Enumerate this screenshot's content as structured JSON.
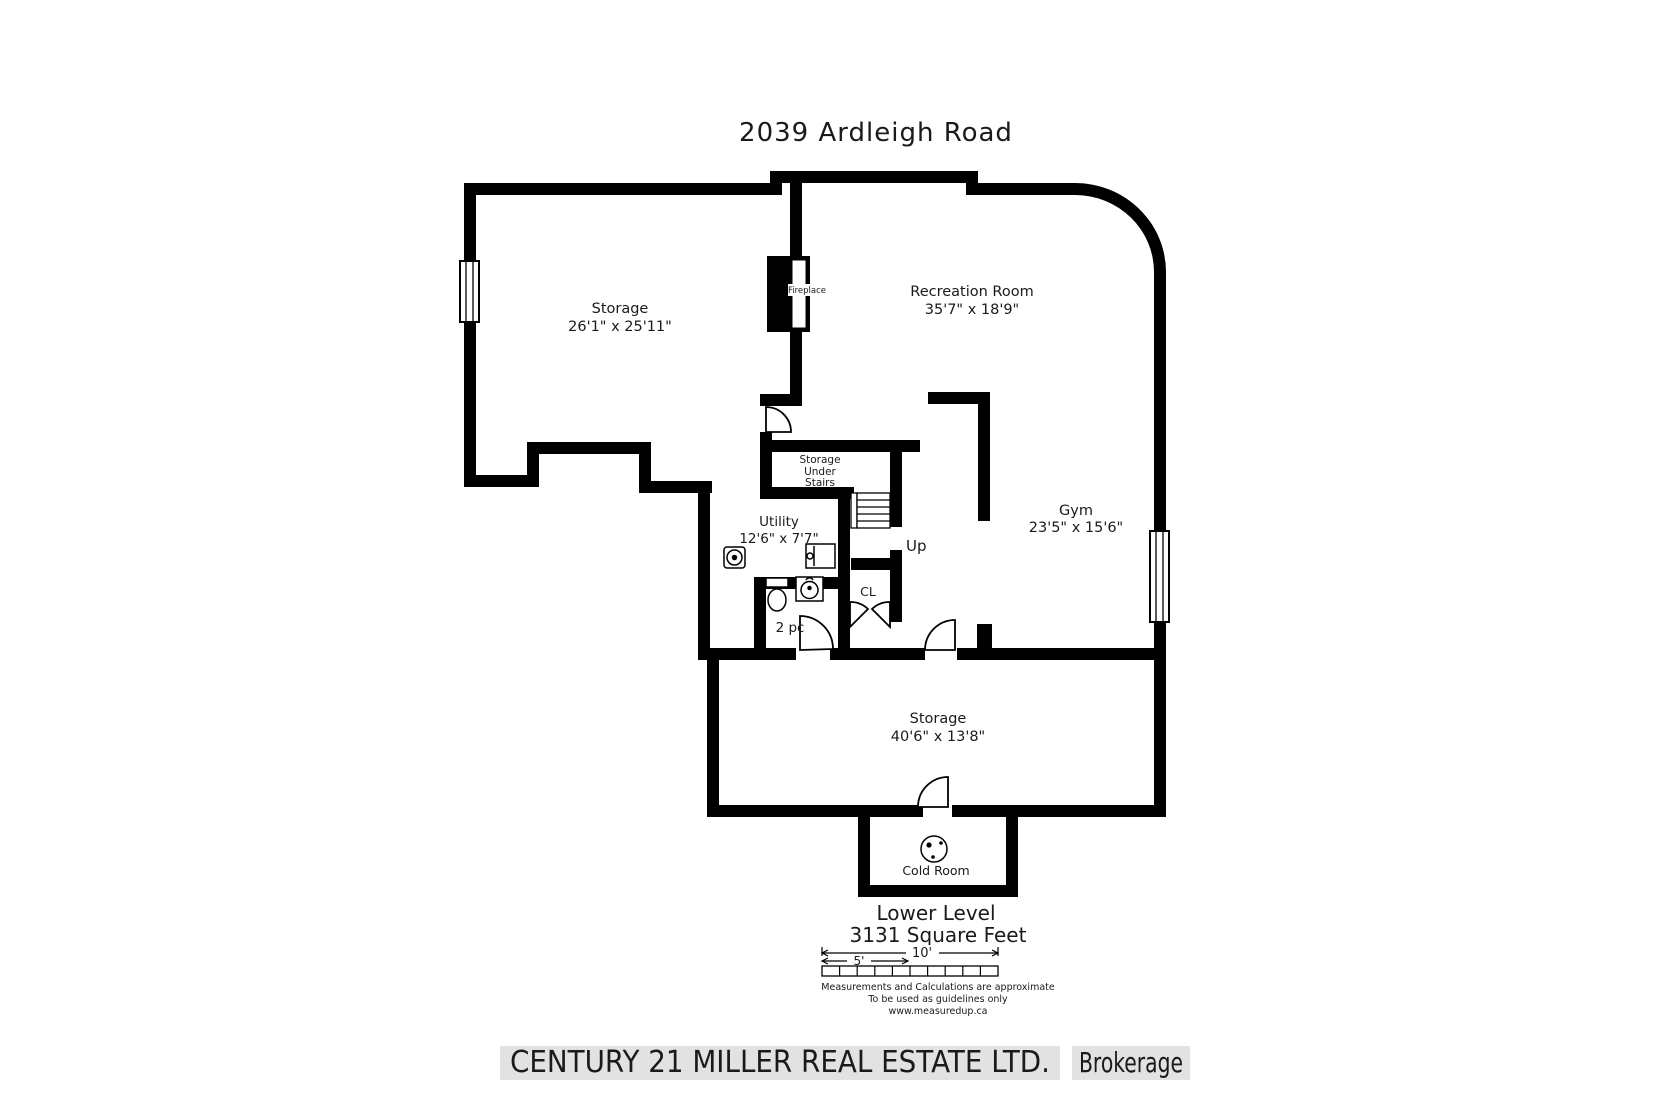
{
  "title": "2039 Ardleigh Road",
  "rooms": {
    "storage_upper": {
      "name": "Storage",
      "dims": "26'1\" x 25'11\""
    },
    "recreation": {
      "name": "Recreation Room",
      "dims": "35'7\" x 18'9\""
    },
    "gym": {
      "name": "Gym",
      "dims": "23'5\" x 15'6\""
    },
    "utility": {
      "name": "Utility",
      "dims": "12'6\" x 7'7\""
    },
    "storage_under_stairs": {
      "line1": "Storage",
      "line2": "Under",
      "line3": "Stairs"
    },
    "bathroom": {
      "name": "2 pc"
    },
    "closet": {
      "name": "CL"
    },
    "storage_lower": {
      "name": "Storage",
      "dims": "40'6\" x 13'8\""
    },
    "cold_room": {
      "name": "Cold Room"
    },
    "fireplace": {
      "name": "Fireplace"
    },
    "stairs": {
      "up_label": "Up"
    }
  },
  "footer": {
    "level": "Lower Level",
    "area": "3131 Square Feet",
    "scale_10": "10'",
    "scale_5": "5'",
    "note1": "Measurements and Calculations are approximate",
    "note2": "To be used as guidelines only",
    "note3": "www.measuredup.ca"
  },
  "watermark": {
    "company": "CENTURY 21 MILLER REAL ESTATE LTD.",
    "suffix": "Brokerage"
  },
  "colors": {
    "wall": "#000000",
    "text": "#1a1a1a",
    "fine_print": "#555555",
    "watermark_bg": "#e2e2e2",
    "watermark_text": "#fcfcfc"
  }
}
